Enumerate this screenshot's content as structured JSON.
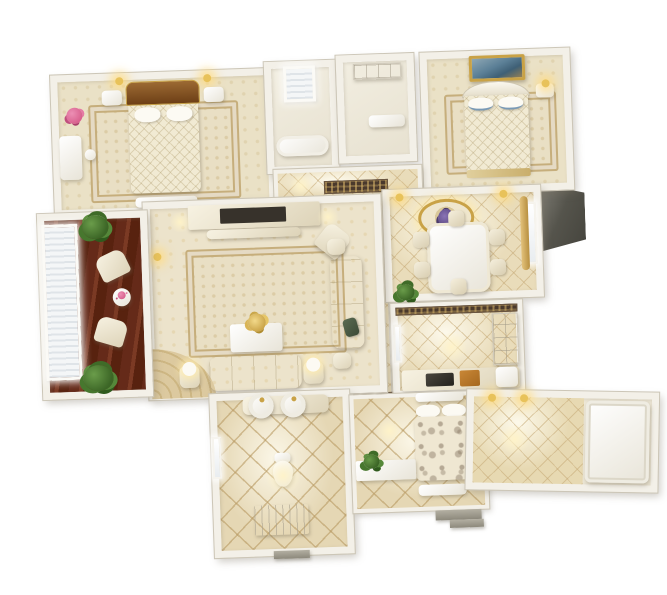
{
  "scene": {
    "description": "Photorealistic 3D dollhouse-style floor plan render of a classic cream-and-gold apartment, viewed from above on a plain white background. No text or labels are rendered in the image.",
    "render_style": "isometric 3D architectural visualization",
    "background_color": "#ffffff",
    "palette": {
      "wall": "#f3f0e8",
      "wall-edge": "#ccc6b7",
      "tile-base": "#e9dcba",
      "tile-line": "#c7ab78",
      "carpet": "#eae1c6",
      "rug-border": "#c6ae7c",
      "wood-a": "#652a19",
      "gold": "#c9a246",
      "glow": "#ffe9a8",
      "green-a": "#6a9c4a",
      "pink": "#d9628f",
      "headboard-a": "#9c6a33",
      "tv": "#37322b",
      "slab-b": "#44433c",
      "paint-b": "#3f6076",
      "curtain": "#d7b469",
      "mosaic": "#4a392c",
      "purple": "#5d4a86",
      "step": "#9d998c"
    },
    "rooms": [
      {
        "id": "master-bedroom",
        "label": "master bedroom",
        "contents": [
          "double bed with brown upholstered headboard",
          "quilted cream bedspread",
          "two round pillows",
          "foot bench",
          "two nightstands",
          "two gold wall sconces",
          "pink flower arrangement",
          "vanity table with stool",
          "beige patterned carpet"
        ]
      },
      {
        "id": "ensuite-bathroom",
        "label": "en-suite bathroom",
        "contents": [
          "bright window with blinds",
          "white bathtub"
        ]
      },
      {
        "id": "walk-in-closet",
        "label": "walk-in closet",
        "contents": [
          "wardrobe unit",
          "low dresser"
        ]
      },
      {
        "id": "bedroom-2",
        "label": "second bedroom",
        "contents": [
          "gold-framed landscape painting",
          "white ornate bed with blue-trimmed pillows",
          "nightstand with lit lamp",
          "beige carpet"
        ]
      },
      {
        "id": "hallway",
        "label": "hallway",
        "contents": [
          "beige diamond tile floor",
          "dark mosaic runner inlays"
        ]
      },
      {
        "id": "dining-room",
        "label": "dining room",
        "contents": [
          "gold ceiling medallion with grape chandelier",
          "white dining table",
          "six cream chairs",
          "window with gold curtains",
          "potted plant",
          "wall sconces"
        ]
      },
      {
        "id": "kitchen",
        "label": "kitchen",
        "contents": [
          "mosaic border strip",
          "upper cabinet wall",
          "counter with dark cooktop",
          "wood cutting board",
          "window"
        ]
      },
      {
        "id": "living-room",
        "label": "living room",
        "contents": [
          "media wall with flat TV",
          "low console",
          "three-seat cream sofa",
          "cream loveseat",
          "angled armchair",
          "dark green side chair",
          "coffee table with gold flower centerpiece",
          "two lamp side tables",
          "patterned area rug",
          "fan-shaped rug",
          "wall sconce"
        ]
      },
      {
        "id": "window-lounge",
        "label": "window lounge nook",
        "contents": [
          "full-height blinds window",
          "dark hardwood floor",
          "two cream armchairs",
          "round tea table",
          "two potted plants"
        ]
      },
      {
        "id": "main-bathroom",
        "label": "main bathroom",
        "contents": [
          "double round-basin vanity with gold faucets",
          "toilet",
          "shower tray with drain",
          "window",
          "entry step"
        ]
      },
      {
        "id": "bedroom-3",
        "label": "small bedroom",
        "contents": [
          "bed with ornate taupe floral duvet",
          "white pillows",
          "wall shelf",
          "foot bench",
          "vanity counter with green plant",
          "entry steps"
        ]
      },
      {
        "id": "balcony",
        "label": "balcony terrace",
        "contents": [
          "diamond tile floor",
          "white daybed panel",
          "gold wall lights"
        ]
      }
    ]
  }
}
